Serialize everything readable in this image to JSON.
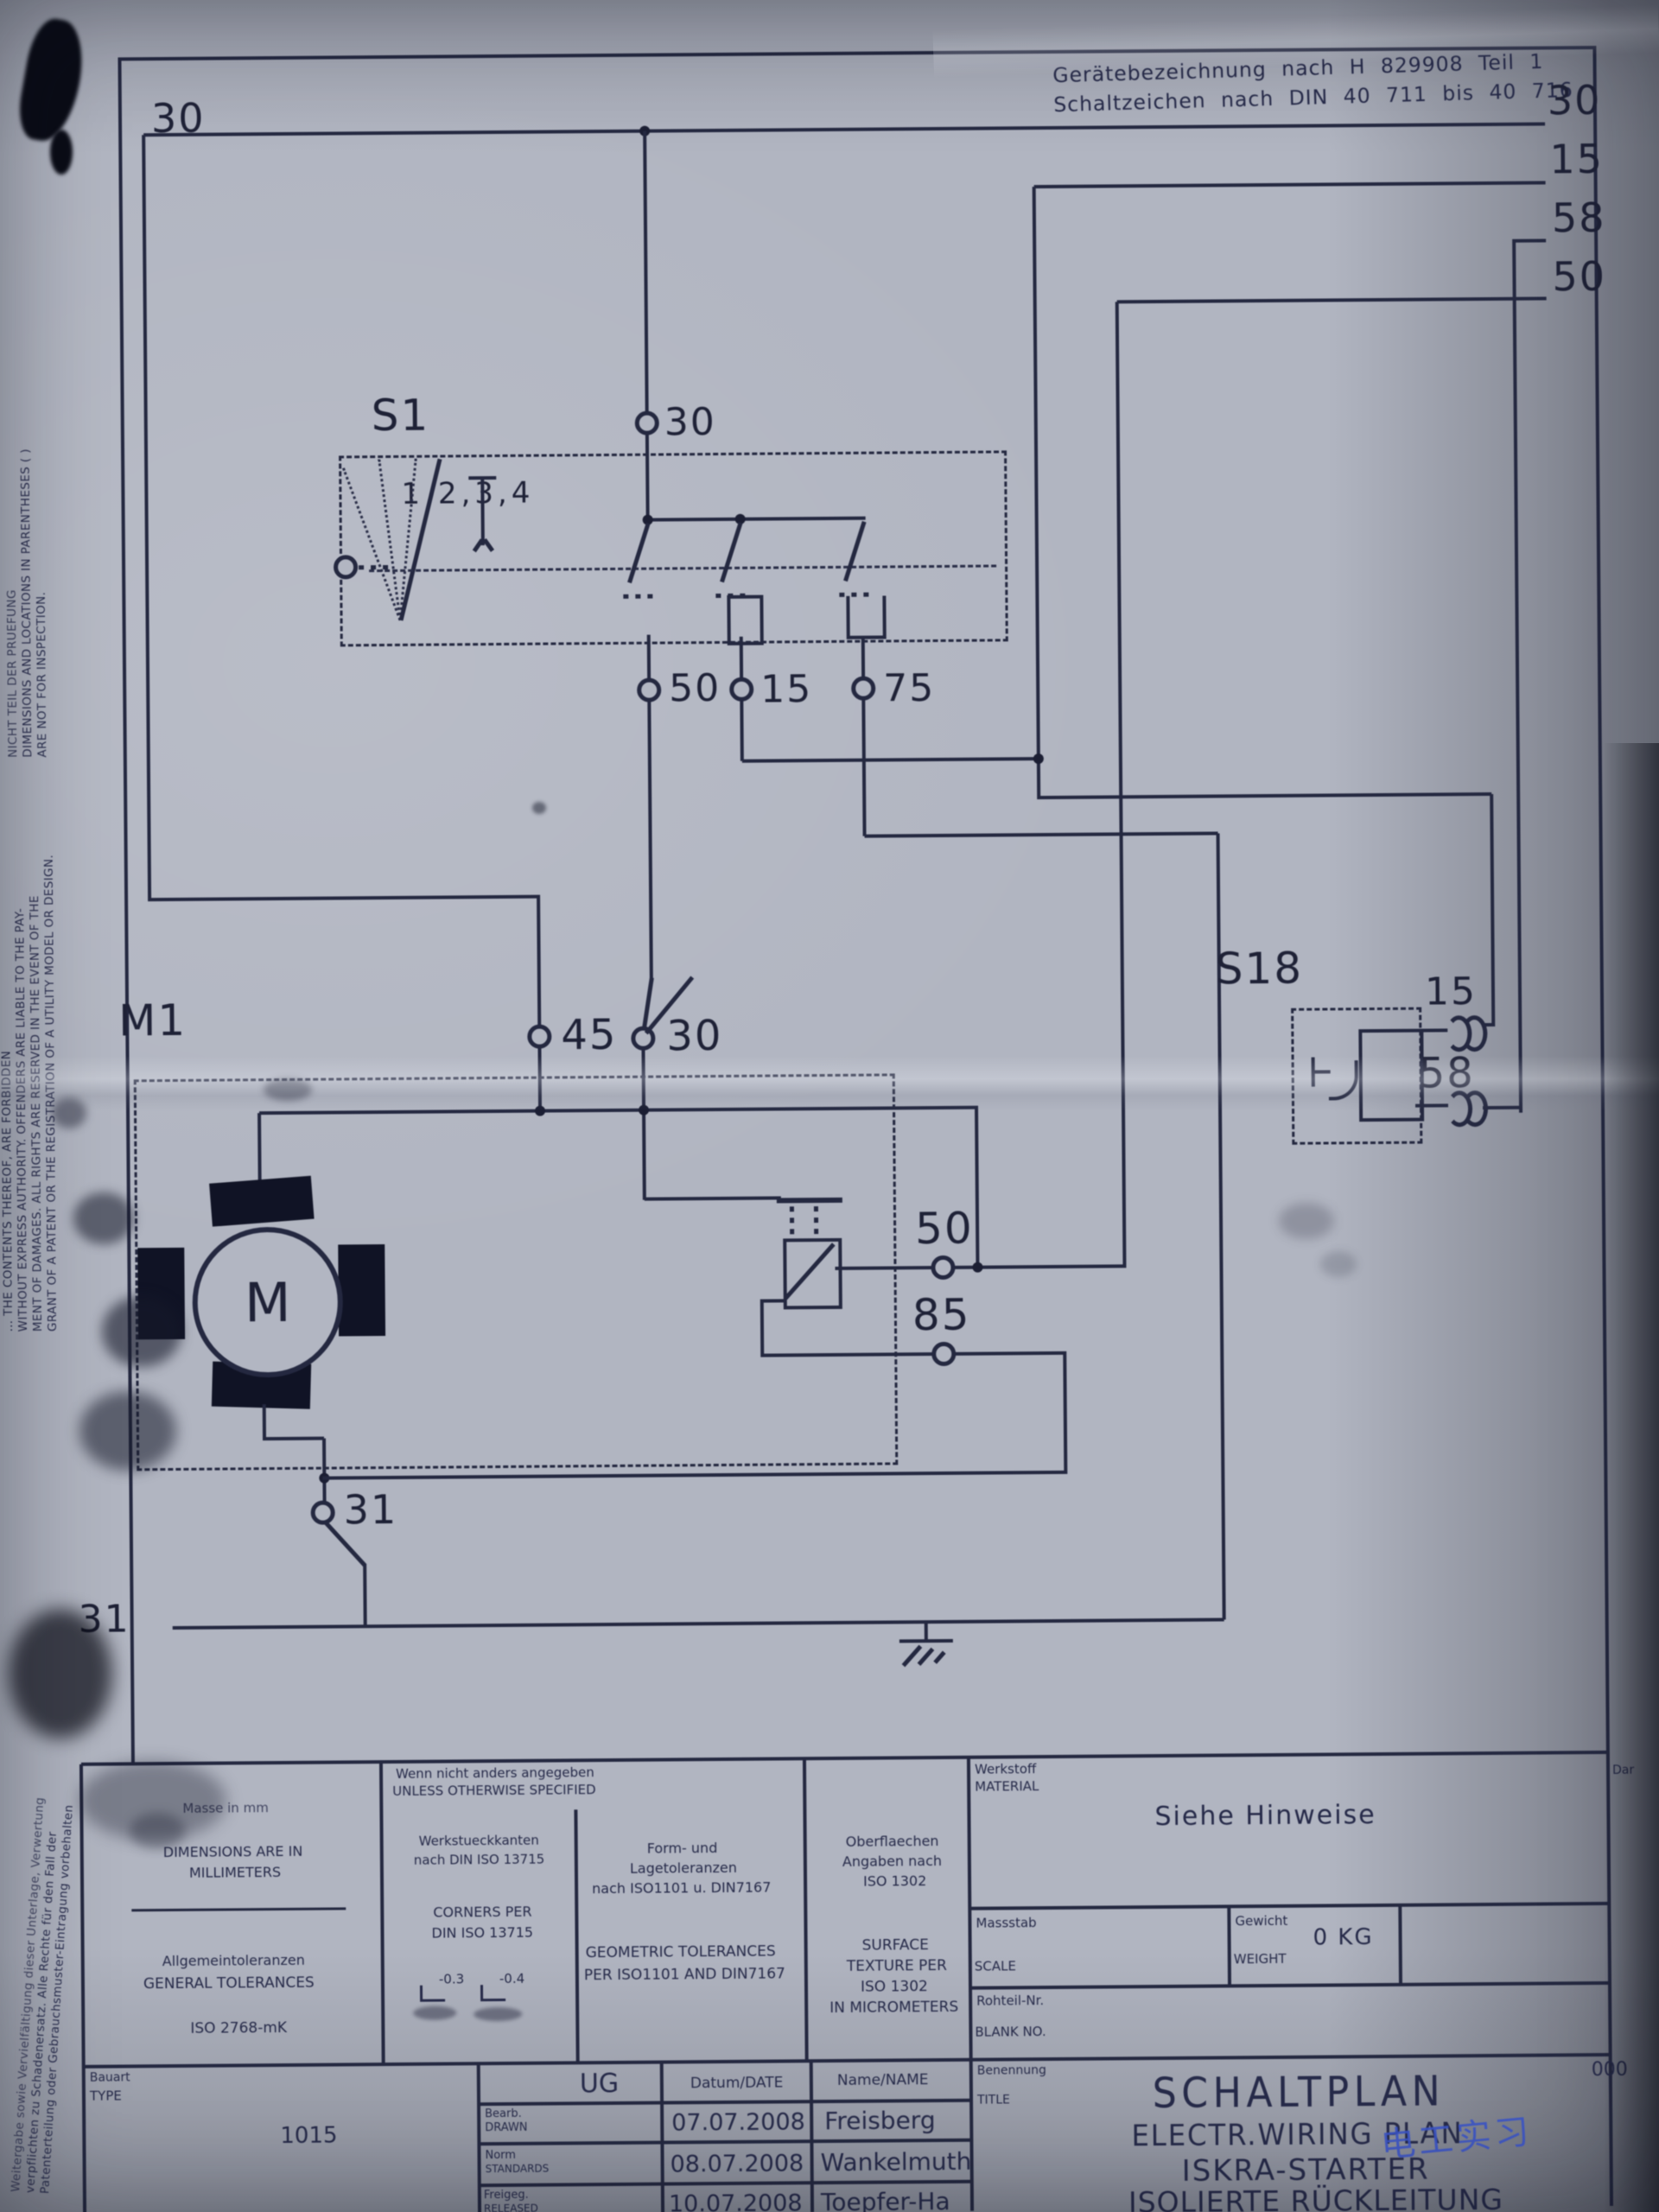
{
  "header": {
    "line1": "Gerätebezeichnung nach H 829908 Teil 1",
    "line2": "Schaltzeichen nach DIN 40 711 bis 40 716"
  },
  "buses": {
    "left_30": "30",
    "right_30": "30",
    "right_15": "15",
    "right_58": "58",
    "right_50": "50",
    "ground_31": "31"
  },
  "s1": {
    "label": "S1",
    "positions": "1,2,3,4",
    "terminal_30": "30",
    "terminal_50": "50",
    "terminal_15": "15",
    "terminal_75": "75"
  },
  "m1": {
    "label": "M1",
    "motor_letter": "M",
    "terminal_45": "45",
    "terminal_30": "30",
    "terminal_31": "31",
    "solenoid_terminal_50": "50",
    "solenoid_terminal_85": "85"
  },
  "s18": {
    "label": "S18",
    "terminal_15": "15",
    "terminal_58": "58"
  },
  "margin": {
    "inspection_de": "NICHT TEIL DER PRUEFUNG",
    "inspection_en1": "DIMENSIONS AND LOCATIONS IN PARENTHESES ( )",
    "inspection_en2": "ARE NOT FOR INSPECTION.",
    "legal_en1": "… THE CONTENTS THEREOF, ARE FORBIDDEN",
    "legal_en2": "WITHOUT EXPRESS AUTHORITY. OFFENDERS ARE LIABLE TO THE PAY-",
    "legal_en3": "MENT OF DAMAGES. ALL RIGHTS ARE RESERVED IN THE EVENT OF THE",
    "legal_en4": "GRANT OF A PATENT OR THE REGISTRATION OF A UTILITY MODEL OR DESIGN.",
    "legal_de1": "Weitergabe sowie Vervielfältigung dieser Unterlage, Verwertung",
    "legal_de2": "verpflichten zu Schadenersatz. Alle Rechte für den Fall der",
    "legal_de3": "Patenterteilung oder Gebrauchsmuster-Eintragung vorbehalten"
  },
  "title_block": {
    "dims_de": "Masse in mm",
    "dims_en1": "DIMENSIONS ARE IN",
    "dims_en2": "MILLIMETERS",
    "gen_tol_de": "Allgemeintoleranzen",
    "gen_tol_en": "GENERAL TOLERANCES",
    "gen_tol_std": "ISO 2768-mK",
    "unless_de": "Wenn nicht anders angegeben",
    "unless_en": "UNLESS OTHERWISE SPECIFIED",
    "corners_de1": "Werkstueckkanten",
    "corners_de2": "nach DIN ISO 13715",
    "corners_en1": "CORNERS PER",
    "corners_en2": "DIN ISO 13715",
    "corner_val1": "-0.3",
    "corner_val2": "-0.4",
    "form_de1": "Form- und",
    "form_de2": "Lagetoleranzen",
    "form_de3": "nach ISO1101 u. DIN7167",
    "form_en1": "GEOMETRIC TOLERANCES",
    "form_en2": "PER ISO1101 AND DIN7167",
    "surf_de1": "Oberflaechen",
    "surf_de2": "Angaben nach",
    "surf_de3": "ISO 1302",
    "surf_en1": "SURFACE",
    "surf_en2": "TEXTURE PER",
    "surf_en3": "ISO 1302",
    "surf_en4": "IN MICROMETERS",
    "material_de": "Werkstoff",
    "material_en": "MATERIAL",
    "material_value": "Siehe Hinweise",
    "scale_de": "Massstab",
    "scale_en": "SCALE",
    "weight_de": "Gewicht",
    "weight_en": "WEIGHT",
    "weight_value": "0 KG",
    "blank_de": "Rohteil-Nr.",
    "blank_en": "BLANK NO.",
    "type_de": "Bauart",
    "type_en": "TYPE",
    "type_value": "1015",
    "ug": "UG",
    "date_header": "Datum/DATE",
    "name_header": "Name/NAME",
    "rows": [
      {
        "role_de": "Bearb.",
        "role_en": "DRAWN",
        "date": "07.07.2008",
        "name": "Freisberg"
      },
      {
        "role_de": "Norm",
        "role_en": "STANDARDS",
        "date": "08.07.2008",
        "name": "Wankelmuth"
      },
      {
        "role_de": "Freigeg.",
        "role_en": "RELEASED",
        "date": "10.07.2008",
        "name": "Toepfer-Ha"
      }
    ],
    "title_de": "Benennung",
    "title_en": "TITLE",
    "title_line1": "SCHALTPLAN",
    "title_line2": "ELECTR.WIRING PLAN",
    "title_line3": "ISKRA-STARTER",
    "title_line4": "ISOLIERTE RÜCKLEITUNG",
    "doc_no_partial": "000",
    "edge_note_partial": "Dar"
  },
  "annotations": {
    "handwriting": "电工实习"
  }
}
